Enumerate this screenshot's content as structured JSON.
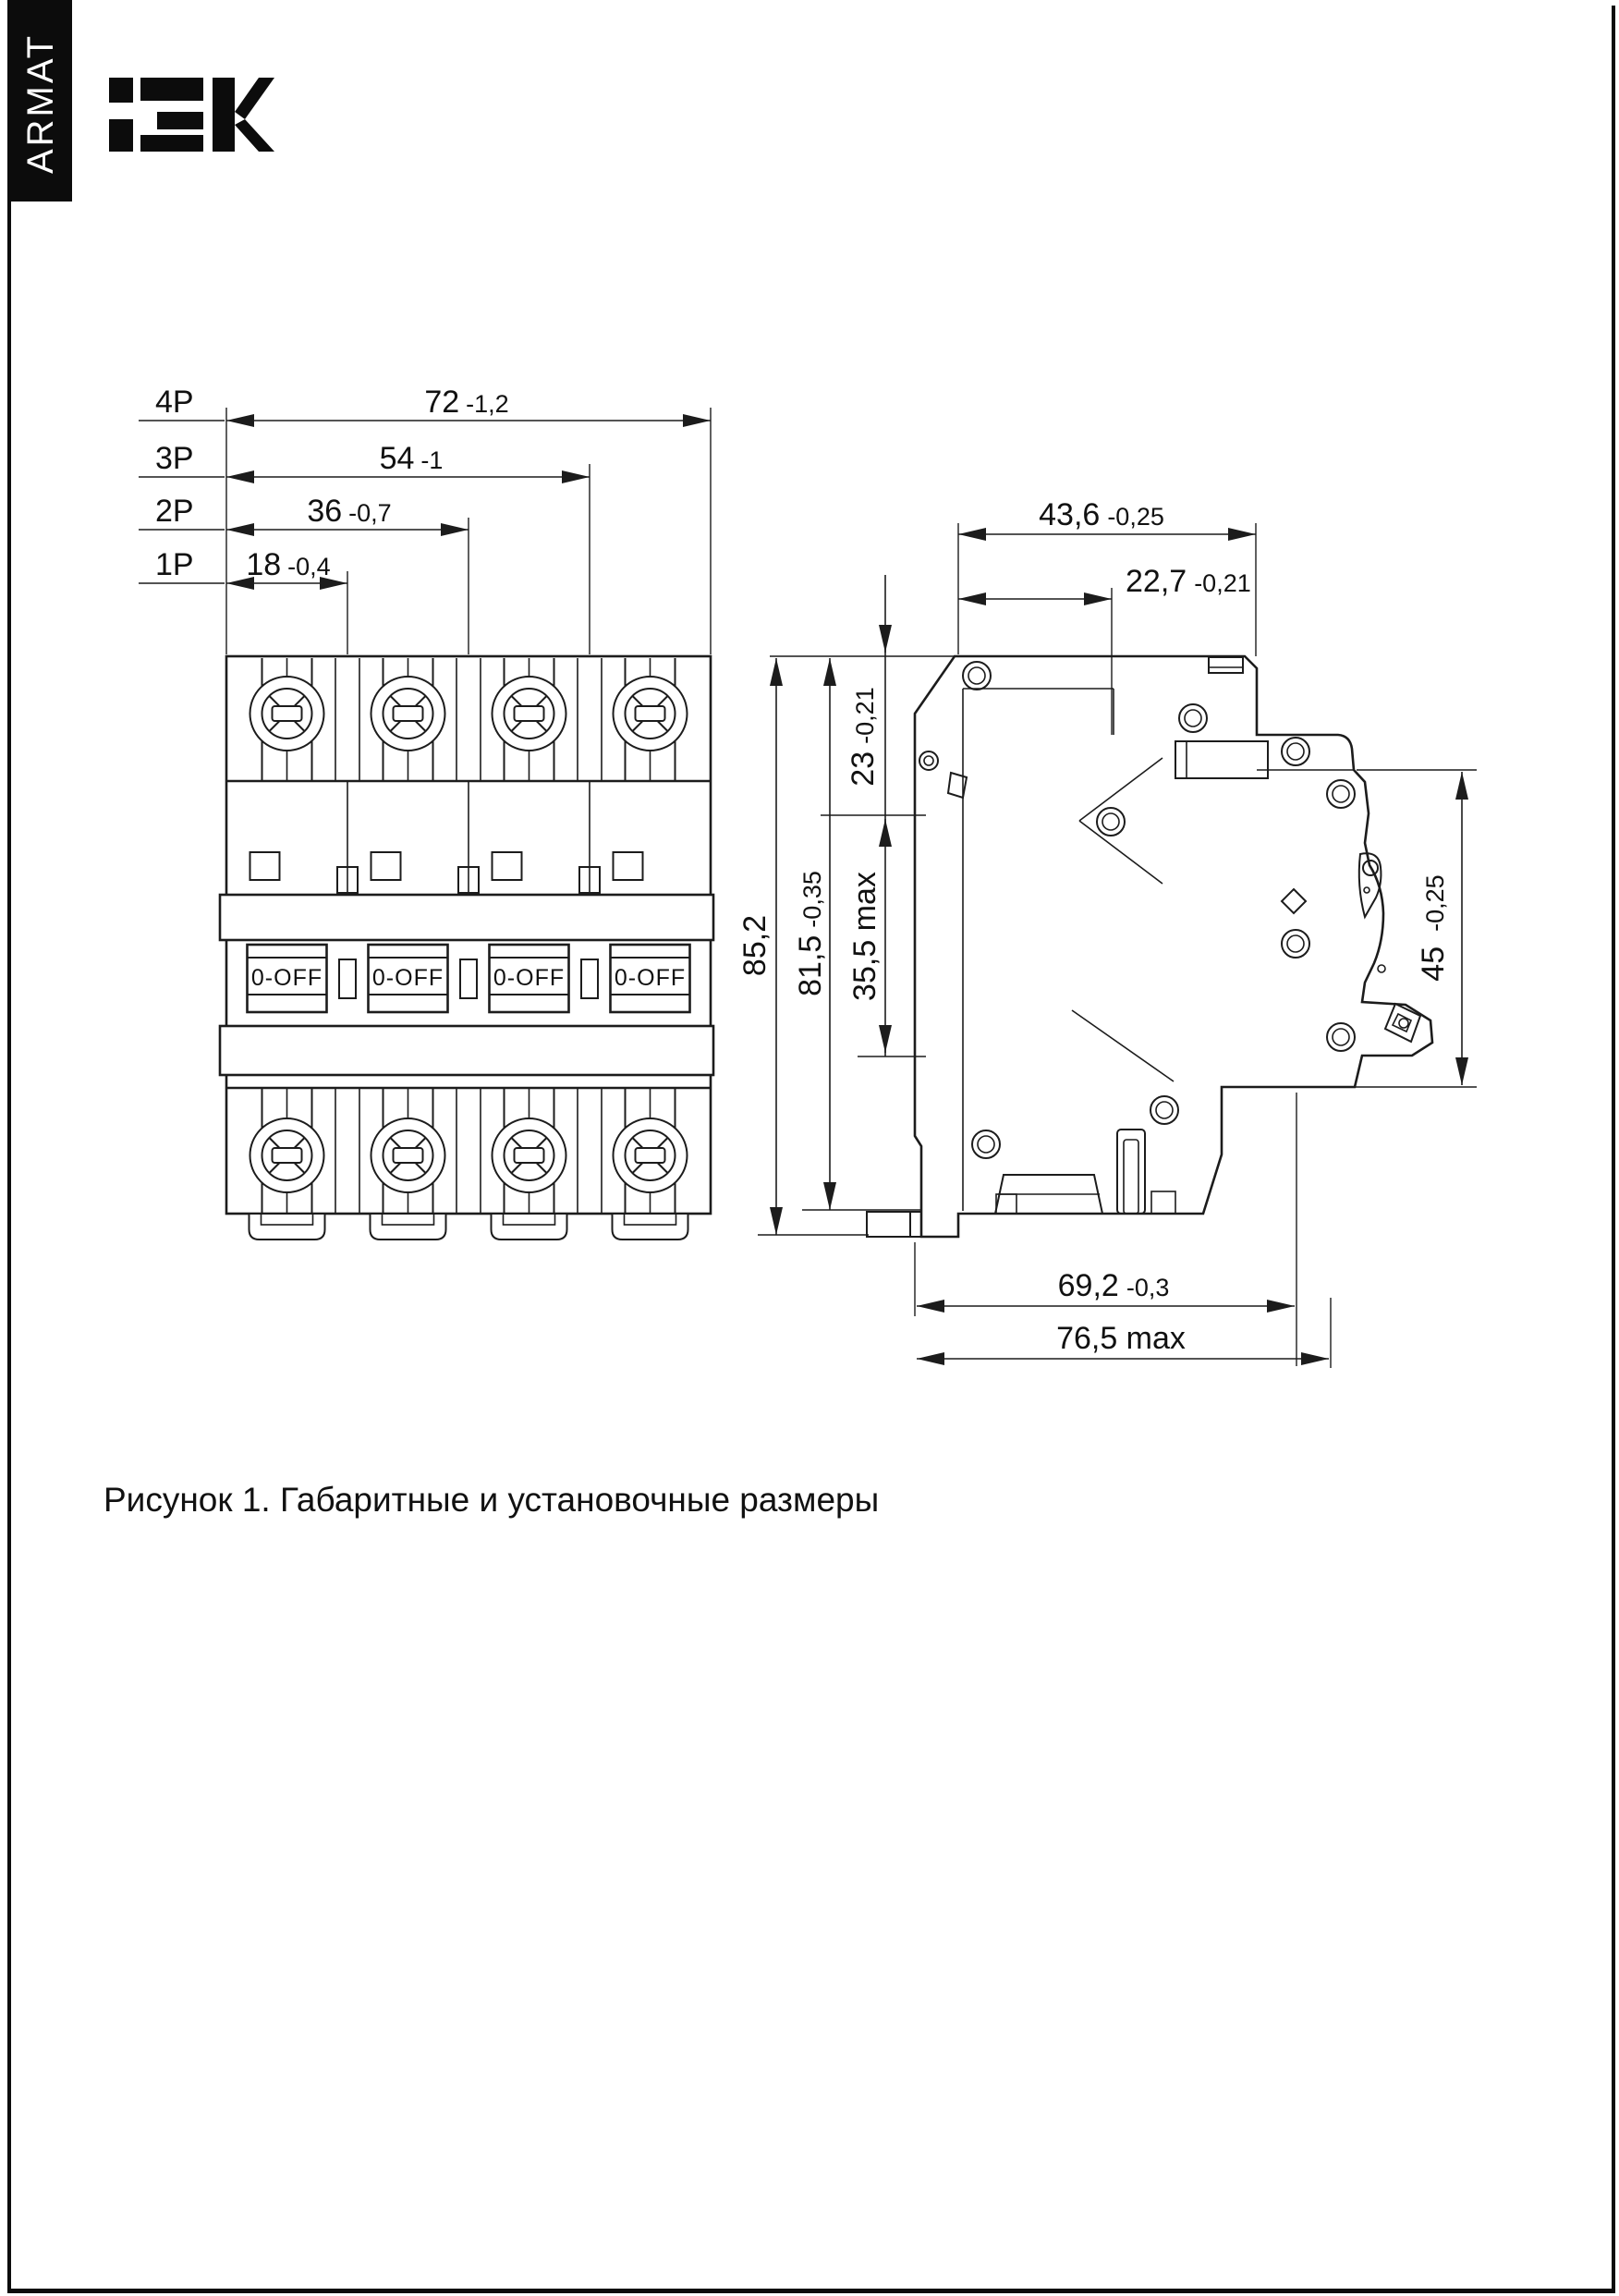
{
  "page": {
    "sidebar_brand": "ARMAT",
    "logo_text": "iEK",
    "caption": "Рисунок 1. Габаритные и установочные размеры"
  },
  "front_view": {
    "toggle_label": "0-OFF",
    "dims": [
      {
        "pole": "4P",
        "value": "72",
        "tol": "-1,2"
      },
      {
        "pole": "3P",
        "value": "54",
        "tol": "-1"
      },
      {
        "pole": "2P",
        "value": "36",
        "tol": "-0,7"
      },
      {
        "pole": "1P",
        "value": "18",
        "tol": "-0,4"
      }
    ]
  },
  "side_view": {
    "dims": {
      "top_depth_overall": {
        "value": "43,6",
        "tol": "-0,25"
      },
      "top_depth_inner": {
        "value": "22,7",
        "tol": "-0,21"
      },
      "front_offset": {
        "value": "23",
        "tol": "-0,21"
      },
      "rail_zone": {
        "value": "35,5 max",
        "tol": ""
      },
      "overall_height": {
        "value": "85,2",
        "tol": ""
      },
      "body_height": {
        "value": "81,5",
        "tol": "-0,35"
      },
      "front_face_height": {
        "value": "45",
        "tol": "-0,25"
      },
      "mount_depth": {
        "value": "69,2",
        "tol": "-0,3"
      },
      "max_depth": {
        "value": "76,5 max",
        "tol": ""
      }
    }
  }
}
